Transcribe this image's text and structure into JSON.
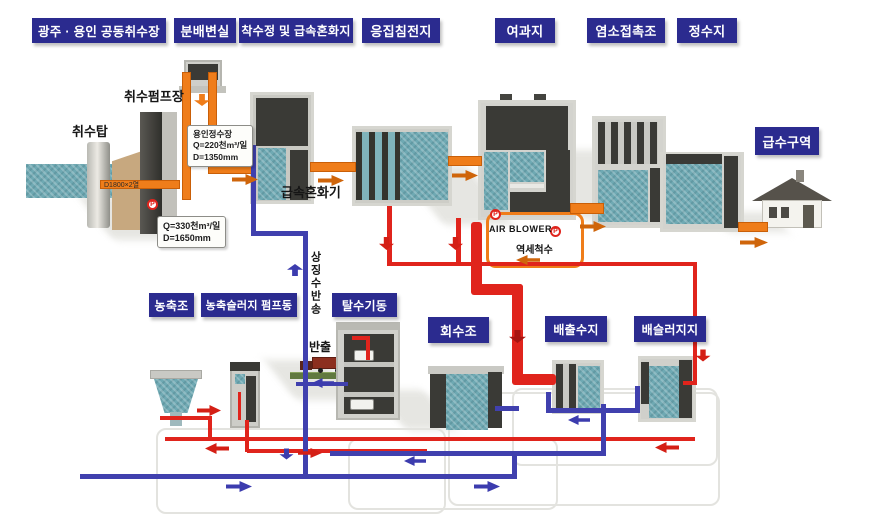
{
  "diagram_type": "water-treatment-plant-process-flow",
  "stages": {
    "intake_station": "광주 · 용인 공동취수장",
    "distribution_chamber": "분배변실",
    "receiving_well": "착수정 및 급속혼화지",
    "coagulation_basin": "응집침전지",
    "filter_basin": "여과지",
    "chlorine_contact_basin": "염소접촉조",
    "clearwell": "정수지",
    "supply_zone": "급수구역",
    "thickener": "농축조",
    "sludge_pump_house": "농축슬러지 펌프동",
    "dewatering_house": "탈수기동",
    "recovery_tank": "회수조",
    "discharge_basin": "배출수지",
    "sludge_basin": "배슬러지지"
  },
  "annotations": {
    "intake_tower": "취수탑",
    "intake_pump_station": "취수펌프장",
    "rapid_mixer": "급속혼화기",
    "air_blower": "AIR BLOWER",
    "backwash_water": "역세척수",
    "supernatant_return": "상징수반송",
    "haul_out": "반출",
    "pipe_spec": "D1800×2열",
    "pump_symbol": "P"
  },
  "callouts": {
    "yongin_plant": {
      "name": "용인정수장",
      "flow": "Q=220천m³/일",
      "diameter": "D=1350mm"
    },
    "intake_line": {
      "flow": "Q=330천m³/일",
      "diameter": "D=1650mm"
    }
  },
  "colors": {
    "label_bg": "#2b2b8f",
    "label_text": "#ffffff",
    "treated_water_pipe": "#ef7d1a",
    "backwash_sludge_pipe": "#e0241c",
    "return_water_pipe": "#4040ae",
    "water_fill": "#6fa9b3"
  }
}
